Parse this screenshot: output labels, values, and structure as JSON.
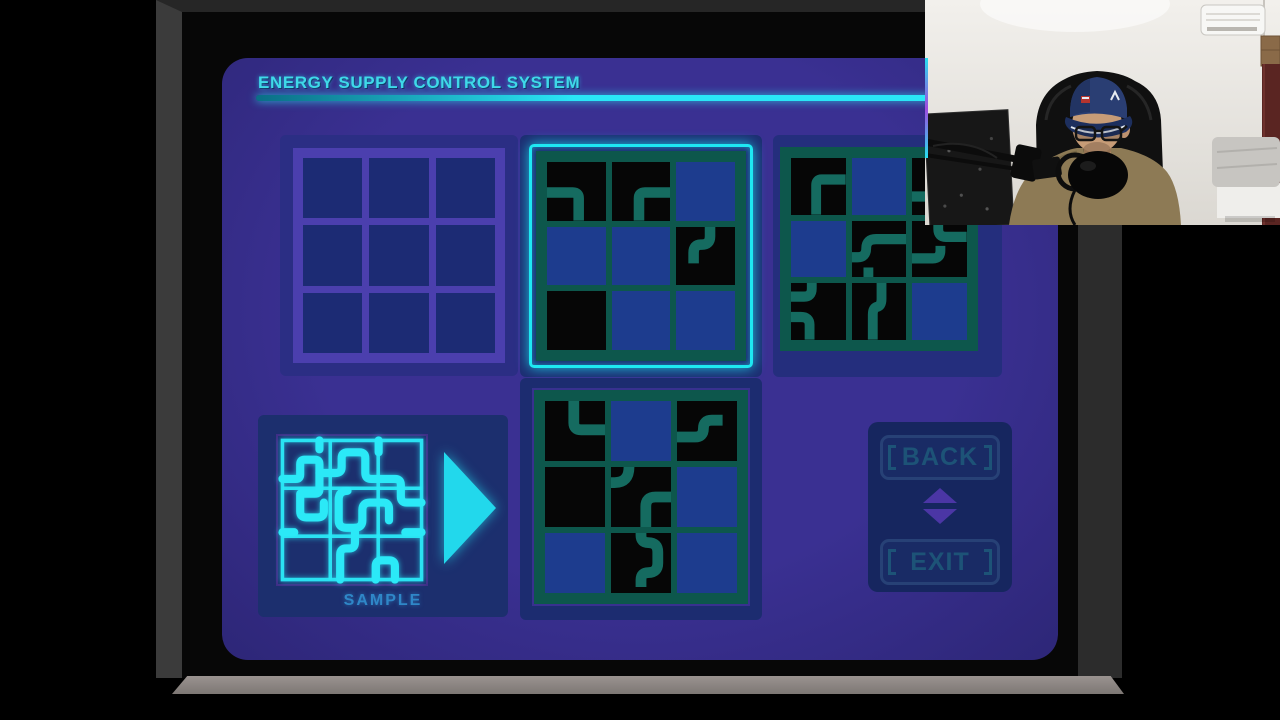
{
  "title": "ENERGY SUPPLY CONTROL SYSTEM",
  "buttons": {
    "back": "BACK",
    "exit": "EXIT"
  },
  "sample": {
    "label": "SAMPLE",
    "arrow_icon": "play-arrow-icon",
    "grid_lines": [
      "M3 3 H97 V97 H3 Z",
      "M35.3 3 V97",
      "M67.7 3 V97",
      "M3 35.3 H97",
      "M3 67.7 H97"
    ],
    "pipes": [
      "M3 29 H12 Q15 29 15 26 V19 Q15 16 18 16 H25 Q28 16 28 19 V36 Q28 39 25 39 H17",
      "M28 3 V9",
      "M28 25 H39 Q43 25 43 21 V15 Q43 11 47 11 H55 Q59 11 59 15 V25 Q59 29 63 29 H79 Q83 29 83 33 V41 Q83 45 87 45 H97",
      "M68 3 V11",
      "M15 39 V51 Q15 55 19 55 H27 Q31 55 31 51 V45",
      "M47 37 Q41 37 41 43 V57 Q41 62 46 62 H52 Q57 62 57 57 V50 Q57 45 62 45 H71 Q75 45 75 49 V57",
      "M52 62 V72 Q52 76 48 76 H46 Q42 76 42 80 V97",
      "M66 97 V88 Q66 84 70 84 H75 Q79 84 79 88 V97",
      "M3 65 H11",
      "M86 65 H97"
    ]
  },
  "colors": {
    "screen": "#3a3092",
    "panel_g1": "#2b2e84",
    "panel_g2": "#1d2d72",
    "panel_g3": "#242e7d",
    "panel_g4": "#1c2c70",
    "panel_sample": "#1c2f6e",
    "panel_buttons": "#16265f",
    "cell_blue": "#1d3c8e",
    "cell_black": "#060606",
    "cell_inactive": "#1c2b74",
    "line_inactive": "#4b3fae",
    "pipe": "#156b60",
    "grid_line": "#0d574c",
    "selection": "#1ee8f2",
    "title_text": "#3fd9e9",
    "button_text": "#1d5377",
    "arrow_purple": "#4b36a5",
    "arrow_cyan": "#22d8ec",
    "sample_cyan": "#2be9f7",
    "label_blue": "#2f87c8"
  },
  "grids": [
    {
      "name": "puzzle-slot-1",
      "state": "empty",
      "cells": [
        {
          "bg": "inactive"
        },
        {
          "bg": "inactive"
        },
        {
          "bg": "inactive"
        },
        {
          "bg": "inactive"
        },
        {
          "bg": "inactive"
        },
        {
          "bg": "inactive"
        },
        {
          "bg": "inactive"
        },
        {
          "bg": "inactive"
        },
        {
          "bg": "inactive"
        }
      ]
    },
    {
      "name": "puzzle-slot-2",
      "state": "selected",
      "cells": [
        {
          "bg": "black",
          "pipes": [
            "M0 52 H44 Q54 52 54 62 V100"
          ]
        },
        {
          "bg": "black",
          "pipes": [
            "M46 100 V62 Q46 52 56 52 H100"
          ]
        },
        {
          "bg": "blue"
        },
        {
          "bg": "blue"
        },
        {
          "bg": "blue"
        },
        {
          "bg": "black",
          "pipes": [
            "M58 0 V16 Q58 30 44 30 H42 Q30 30 30 44 V62"
          ]
        },
        {
          "bg": "black"
        },
        {
          "bg": "blue"
        },
        {
          "bg": "blue"
        }
      ]
    },
    {
      "name": "puzzle-slot-3",
      "state": "normal",
      "cells": [
        {
          "bg": "black",
          "pipes": [
            "M46 100 V48 Q46 38 56 38 H100"
          ]
        },
        {
          "bg": "blue"
        },
        {
          "bg": "black",
          "pipes": [
            "M0 68 H52 Q68 68 68 84 V100"
          ]
        },
        {
          "bg": "blue"
        },
        {
          "bg": "black",
          "pipes": [
            "M0 64 H10 Q26 64 26 48 Q26 32 44 32 H100",
            "M30 100 V82"
          ]
        },
        {
          "bg": "black",
          "pipes": [
            "M48 0 V14 Q48 28 62 28 H100",
            "M0 66 H38 Q52 66 52 52 V44"
          ]
        },
        {
          "bg": "black",
          "pipes": [
            "M38 0 V10 Q38 24 24 24 H0",
            "M0 60 H18 Q34 60 34 74 V100"
          ]
        },
        {
          "bg": "black",
          "pipes": [
            "M54 0 V28 Q54 40 46 42 Q38 44 38 56 V100"
          ]
        },
        {
          "bg": "blue"
        }
      ]
    },
    {
      "name": "puzzle-slot-4",
      "state": "normal",
      "cells": [
        {
          "bg": "black",
          "pipes": [
            "M48 0 V36 Q48 48 60 48 H100"
          ]
        },
        {
          "bg": "blue"
        },
        {
          "bg": "black",
          "pipes": [
            "M0 60 H30 Q44 60 44 46 Q44 32 58 32 H76"
          ]
        },
        {
          "bg": "black"
        },
        {
          "bg": "black",
          "pipes": [
            "M30 0 Q30 26 6 26 H0",
            "M100 50 H74 Q58 50 58 66 V100"
          ]
        },
        {
          "bg": "blue"
        },
        {
          "bg": "blue"
        },
        {
          "bg": "black",
          "pipes": [
            "M50 0 V4 Q50 16 62 16 Q78 16 78 32 V50 Q78 66 62 66 Q50 66 50 78 V90"
          ]
        },
        {
          "bg": "blue"
        }
      ]
    }
  ],
  "webcam": {
    "elements": [
      "streamer",
      "gaming-chair",
      "blue-cap",
      "glasses",
      "microphone",
      "boom-arm",
      "air-conditioner",
      "bed",
      "equipment-case",
      "door"
    ]
  }
}
